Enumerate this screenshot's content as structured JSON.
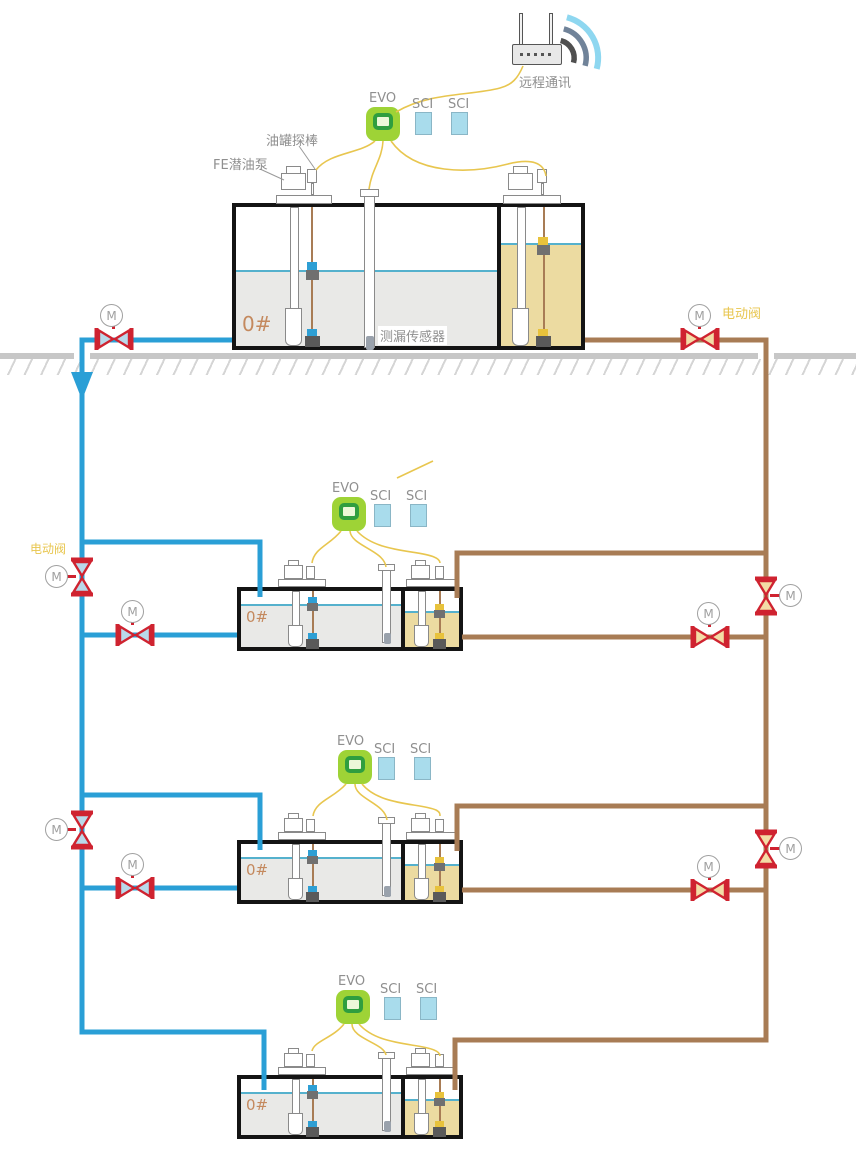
{
  "labels": {
    "remote_comm": "远程通讯",
    "evo": "EVO",
    "sci": "SCI",
    "tank_probe": "油罐探棒",
    "pump": "FE潜油泵",
    "leak_sensor": "测漏传感器",
    "grade": "0#",
    "electric_valve": "电动阀",
    "motor": "M"
  },
  "colors": {
    "pipe_blue": "#2a9fd6",
    "pipe_brown": "#a87c55",
    "valve_red": "#cf2330",
    "valve_fill_blue": "#b9d9ea",
    "valve_fill_tan": "#f3dca6",
    "wire_yellow": "#e8c64f",
    "evo_green": "#9ed336",
    "sci_blue": "#a9dcec",
    "diesel_fill": "#e9e9e7",
    "gasoline_fill": "#ecdba1",
    "liquid_line": "#55b1cd",
    "label_gray": "#8f8f8f",
    "grade_color": "#c4895e",
    "electric_valve_label": "#e8c64f"
  }
}
